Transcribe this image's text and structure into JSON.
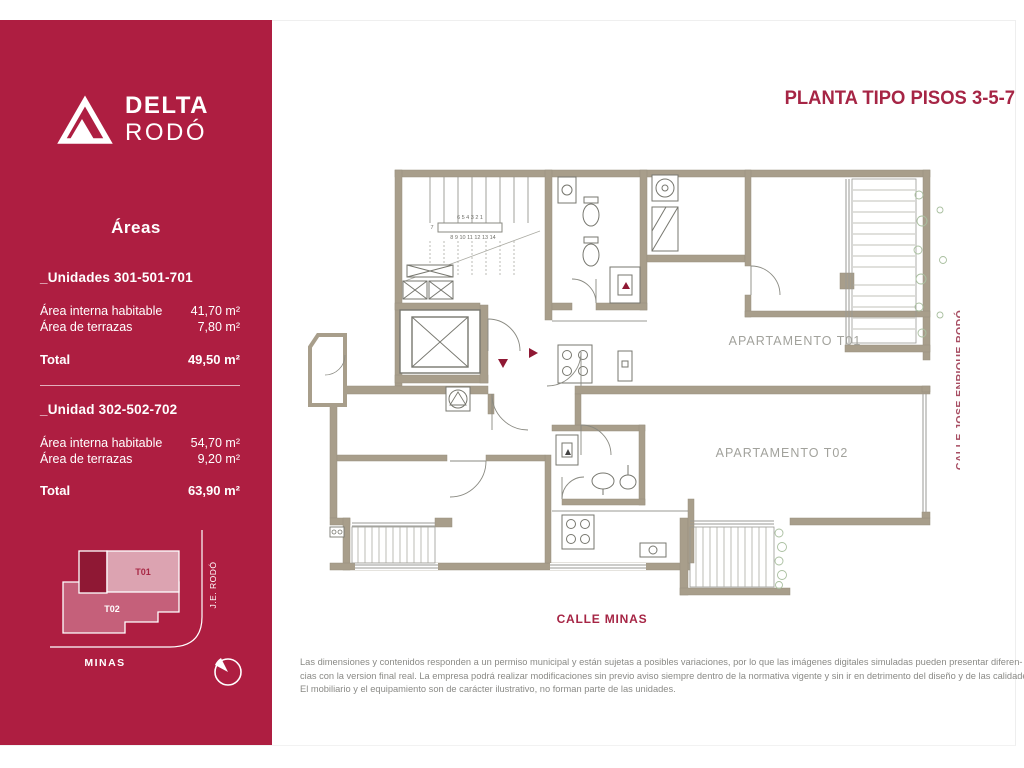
{
  "brand": {
    "name_line1": "DELTA",
    "name_line2": "RODÓ"
  },
  "sidebar": {
    "areas_title": "Áreas",
    "units": [
      {
        "title": "_Unidades 301-501-701",
        "rows": [
          {
            "label": "Área interna habitable",
            "value": "41,70 m²"
          },
          {
            "label": "Área de terrazas",
            "value": "7,80 m²"
          }
        ],
        "total_label": "Total",
        "total_value": "49,50 m²"
      },
      {
        "title": "_Unidad 302-502-702",
        "rows": [
          {
            "label": "Área interna habitable",
            "value": "54,70 m²"
          },
          {
            "label": "Área de terrazas",
            "value": "9,20 m²"
          }
        ],
        "total_label": "Total",
        "total_value": "63,90 m²"
      }
    ],
    "minimap": {
      "t01_label": "T01",
      "t02_label": "T02",
      "street_vertical": "J.E. RODÓ",
      "street_bottom": "MINAS"
    }
  },
  "main": {
    "title": "PLANTA TIPO PISOS 3-5-7",
    "plan": {
      "apartment1_label": "APARTAMENTO T01",
      "apartment2_label": "APARTAMENTO T02",
      "street_right": "CALLE JOSE ENRIQUE RODÓ",
      "street_bottom": "CALLE MINAS",
      "stair_numbers_row1": "6  5  4  3  2  1",
      "stair_number_mid": "7",
      "stair_numbers_row2": "8 9 10 11 12 13 14"
    },
    "disclaimer": {
      "line1": "Las dimensiones y contenidos responden a un permiso municipal y están sujetas a posibles variaciones, por lo que las imágenes digitales simuladas pueden presentar diferen-",
      "line2": "cias con la version final real. La empresa podrá realizar modificaciones sin previo aviso siempre dentro de la normativa vigente y sin ir en detrimento del diseño y de las calidades.",
      "line3": "El mobiliario y el equipamiento son de carácter ilustrativo, no forman parte de las unidades."
    }
  },
  "colors": {
    "brand_crimson": "#AE1E41",
    "dark_crimson": "#8F1834",
    "wall_taupe": "#A89E8B",
    "minimap_pink_light": "#DCA3B1",
    "minimap_pink_mid": "#C5607A",
    "plan_line_gray": "#77776F",
    "label_gray": "#A2A29C",
    "plant_green": "#A9BF9F"
  }
}
